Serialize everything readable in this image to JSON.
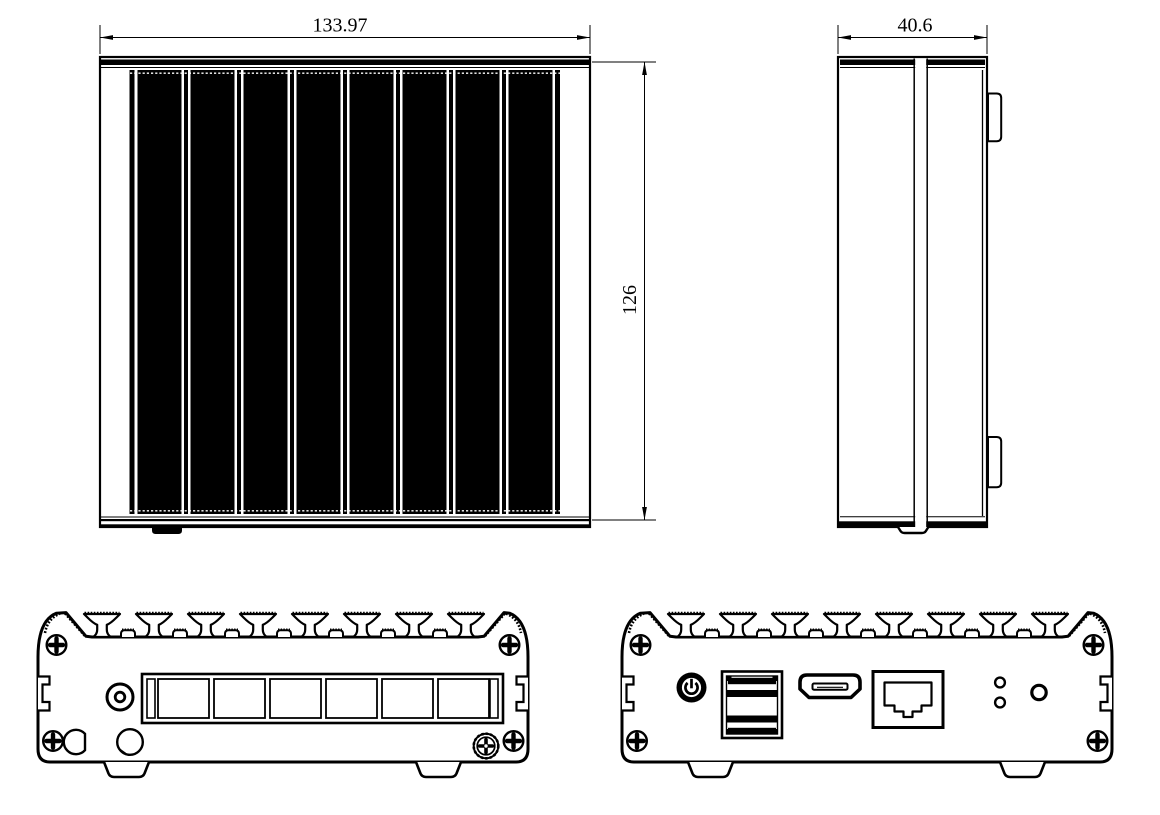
{
  "dimensions": {
    "top_view_width": "133.97",
    "top_view_height": "126",
    "side_view_depth": "40.6"
  },
  "colors": {
    "line": "#000000",
    "background": "#ffffff"
  },
  "icons": {
    "power_button_glyph": "power-icon"
  }
}
